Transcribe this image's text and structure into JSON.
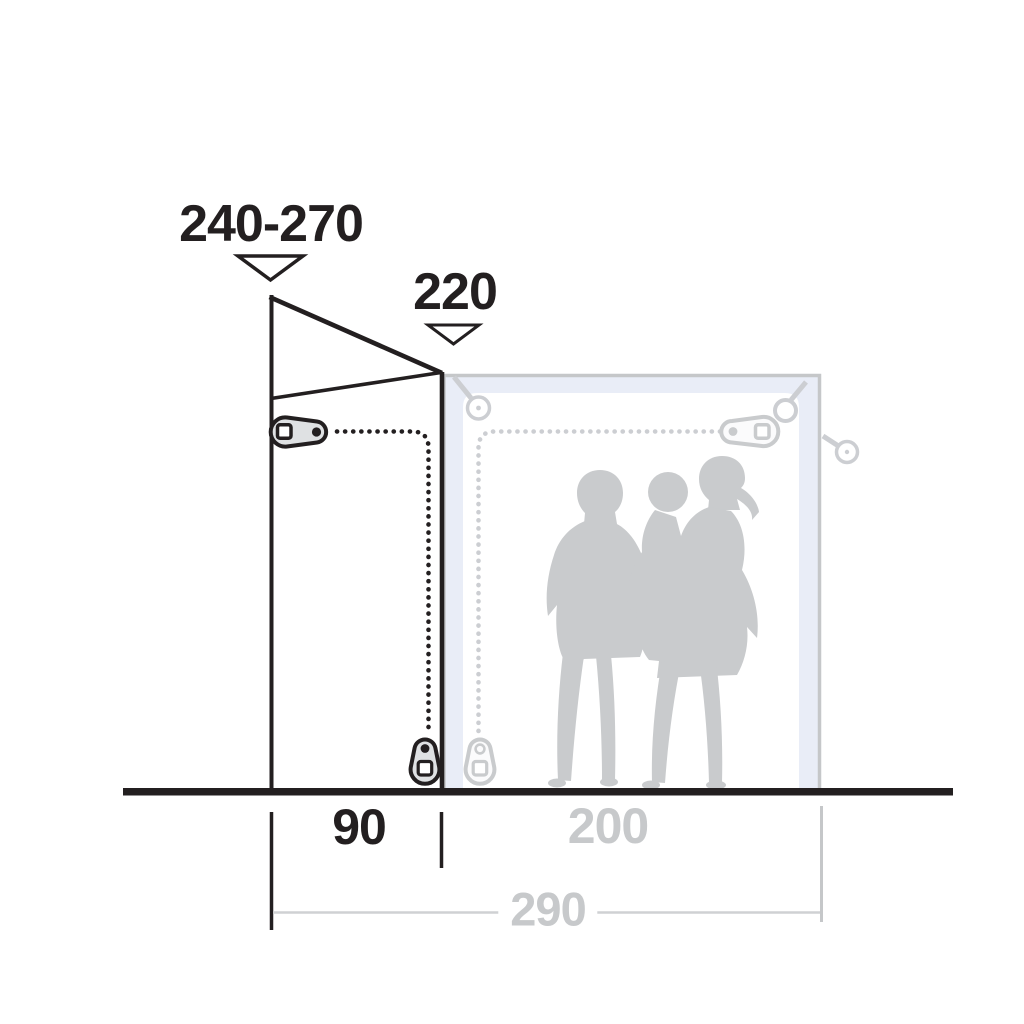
{
  "diagram": {
    "description": "Tent awning side-profile dimension diagram with two adult silhouettes and a child for scale",
    "dimension_labels": {
      "peak_height_range": "240-270",
      "front_height": "220",
      "front_depth": "90",
      "rear_depth": "200",
      "total_depth": "290"
    },
    "icons": {
      "down_arrow": "open triangle pointing down",
      "guy_rope_peg": "circle grommet with cord",
      "zipper_pull": "zip slider fob",
      "zipper_track": "dotted line"
    },
    "colors": {
      "ink": "#231f20",
      "muted_gray": "#c9cbcd",
      "icon_gray": "#ccced2",
      "panel_fill": "#e9edf7",
      "panel_border": "#c5c7c9",
      "background": "#ffffff"
    }
  }
}
